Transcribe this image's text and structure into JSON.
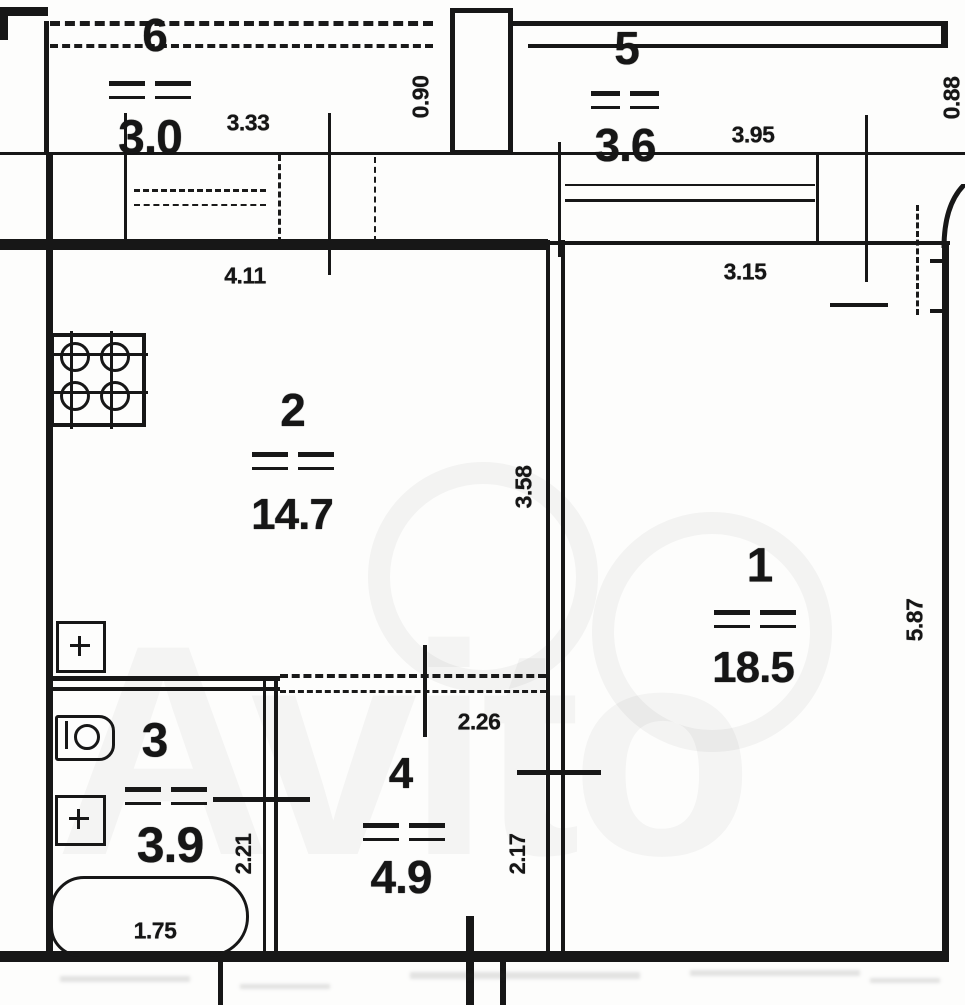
{
  "plan": {
    "watermark": "Avito",
    "rooms": [
      {
        "id": "balcony-6",
        "number": "6",
        "area": "3.0"
      },
      {
        "id": "balcony-5",
        "number": "5",
        "area": "3.6"
      },
      {
        "id": "kitchen-2",
        "number": "2",
        "area": "14.7"
      },
      {
        "id": "living-1",
        "number": "1",
        "area": "18.5"
      },
      {
        "id": "bath-3",
        "number": "3",
        "area": "3.9"
      },
      {
        "id": "hall-4",
        "number": "4",
        "area": "4.9"
      }
    ],
    "dimensions": {
      "balcony6_width": "3.33",
      "balcony6_depth": "0.90",
      "balcony5_width": "3.95",
      "balcony5_depth": "0.88",
      "kitchen_width": "4.11",
      "room1_width": "3.15",
      "kitchen_depth": "3.58",
      "room1_depth": "5.87",
      "hall_width": "2.26",
      "hall_depth": "2.17",
      "bath_depth": "2.21",
      "bathtub_length": "1.75"
    },
    "fixtures": [
      "stove",
      "kitchen-sink",
      "toilet",
      "wash-sink",
      "bathtub"
    ]
  }
}
